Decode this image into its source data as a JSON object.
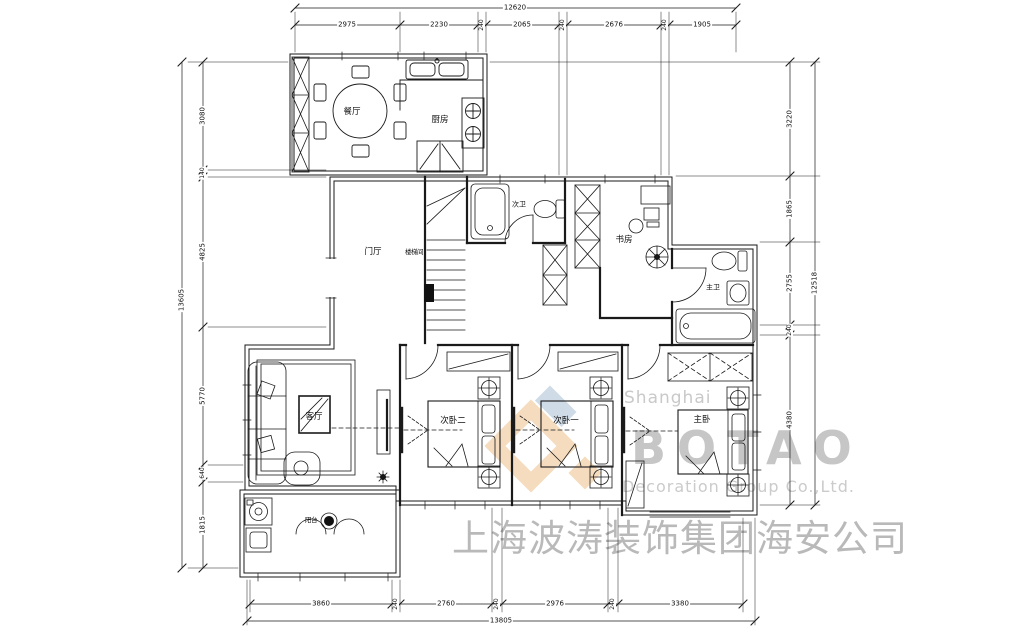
{
  "watermark": {
    "line1": "Shanghai",
    "line2": "BOTAO",
    "line3": "Decoration Group Co.,Ltd.",
    "line4": "上海波涛装饰集团海安公司"
  },
  "colors": {
    "logo_tan": "#eec08a",
    "logo_blue": "#a9bfd3",
    "watermark_text": "#c0c0c0",
    "line": "#1a1a1a"
  },
  "rooms": {
    "dining": "餐厅",
    "kitchen": "厨房",
    "foyer": "门厅",
    "stairs": "楼梯间",
    "bath2": "次卫",
    "study": "书房",
    "master_bath": "主卫",
    "living": "客厅",
    "bedroom2": "次卧二",
    "bedroom1": "次卧一",
    "master_bedroom": "主卧",
    "balcony": "阳台"
  },
  "dimensions": {
    "top": {
      "total": "12620",
      "segments": [
        "2975",
        "2230",
        "240",
        "2065",
        "240",
        "2676",
        "240",
        "1905"
      ]
    },
    "bottom": {
      "total": "13805",
      "segments": [
        "3860",
        "240",
        "2760",
        "240",
        "2976",
        "240",
        "3380"
      ]
    },
    "left": {
      "total": "13605",
      "segments": [
        "3080",
        "140",
        "4825",
        "5770",
        "640",
        "1815"
      ]
    },
    "right": {
      "total": "12518",
      "segments": [
        "3220",
        "1865",
        "2755",
        "240",
        "4380"
      ]
    }
  }
}
